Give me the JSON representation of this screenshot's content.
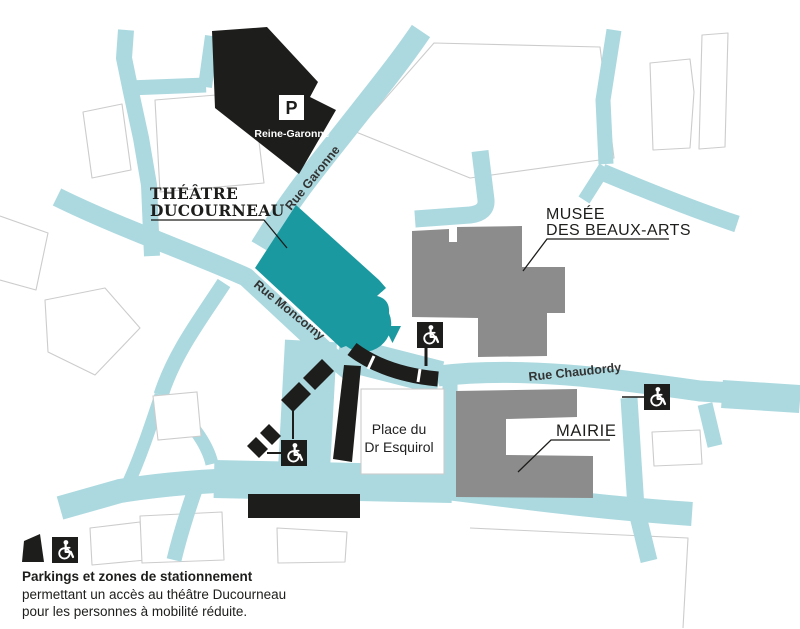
{
  "map": {
    "landmarks": {
      "theatre": {
        "name_line1": "THÉÂTRE",
        "name_line2": "DUCOURNEAU"
      },
      "musee": {
        "name_line1": "MUSÉE",
        "name_line2": "DES BEAUX-ARTS"
      },
      "mairie": {
        "name": "MAIRIE"
      },
      "place": {
        "name_line1": "Place du",
        "name_line2": "Dr Esquirol"
      },
      "parking_reine_garonne": {
        "symbol": "P",
        "name": "Reine-Garonne"
      }
    },
    "streets": [
      {
        "id": "garonne",
        "name": "Rue Garonne"
      },
      {
        "id": "moncorny",
        "name": "Rue Moncorny"
      },
      {
        "id": "chaudordy",
        "name": "Rue Chaudordy"
      }
    ],
    "colors": {
      "street": "#abd9df",
      "public_building": "#8c8c8c",
      "theatre": "#1b99a0",
      "parking": "#1d1d1b",
      "outline": "#cccccc",
      "marker": "#1b99a0",
      "background": "#ffffff"
    },
    "icons": {
      "wheelchair": "wheelchair-icon",
      "parking": "parking-p-icon"
    }
  },
  "legend": {
    "title": "Parkings et zones de stationnement",
    "line2": "permettant un accès au théâtre Ducourneau",
    "line3": "pour les personnes à mobilité réduite."
  }
}
